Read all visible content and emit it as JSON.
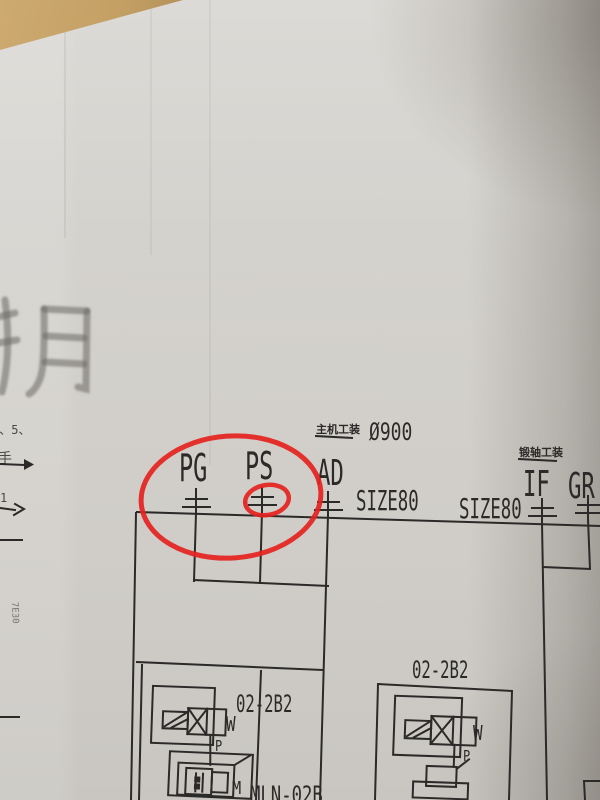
{
  "schematic": {
    "ports": [
      {
        "label": "PG"
      },
      {
        "label": "PS"
      },
      {
        "label": "AD"
      },
      {
        "label": "IF"
      },
      {
        "label": "GR"
      }
    ],
    "size_label_1": "SIZE80",
    "size_label_2": "SIZE80",
    "diameter": "Ø900",
    "note_above_ad": "主机工装",
    "note_above_if": "锻轴工装",
    "left_valve": {
      "model": "02-2B2",
      "code": "MLN-02B",
      "spring": "W",
      "port": "P",
      "motor": "M"
    },
    "right_valve": {
      "model": "02-2B2",
      "spring": "W",
      "port": "P"
    }
  },
  "margin": {
    "faint_text": "手月",
    "numbers": "1、5、",
    "hand_char": "手",
    "digit": "1",
    "vertical_code": "7E30"
  },
  "annotation": {
    "pen_color": "#e5231e"
  },
  "ink_color": "#2b2a28"
}
